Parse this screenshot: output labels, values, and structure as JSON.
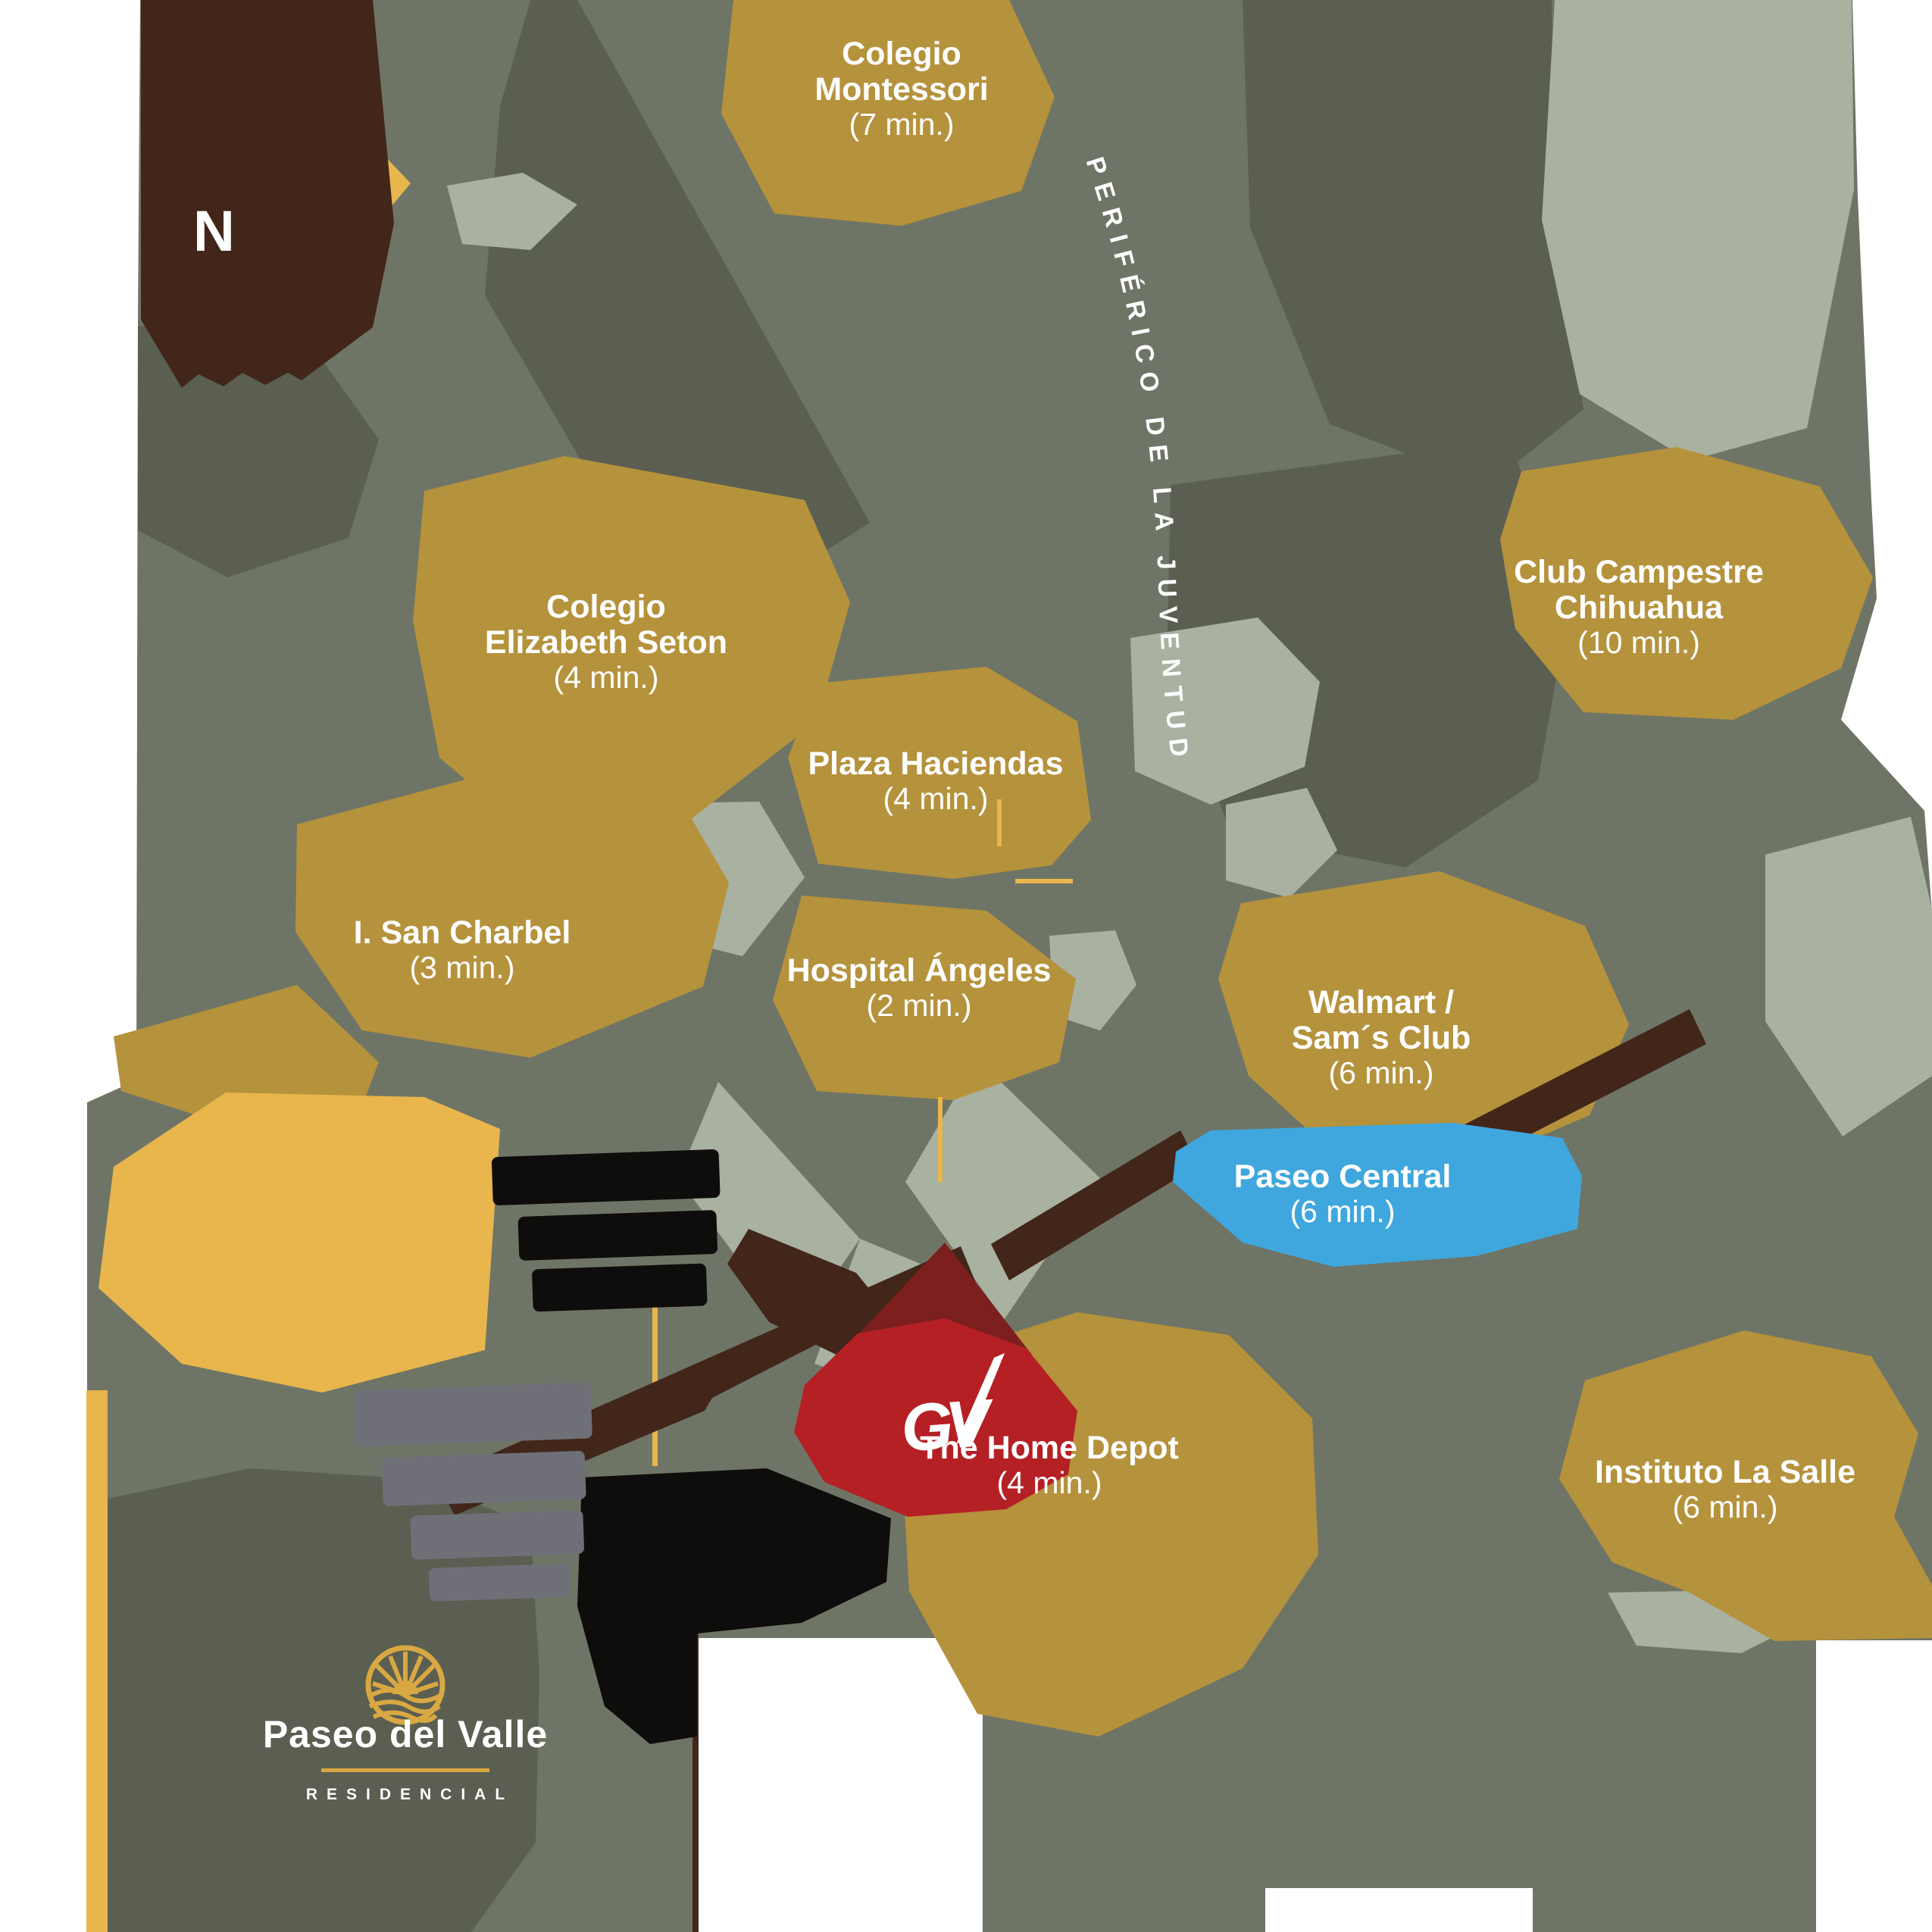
{
  "map": {
    "compass_label": "N",
    "road_label": "PERIFÉRICO DE LA JUVENTUD",
    "locations": [
      {
        "id": "colegio-montessori",
        "name": "Colegio\nMontessori",
        "time": "(7 min.)"
      },
      {
        "id": "club-campestre",
        "name": "Club Campestre\nChihuahua",
        "time": "(10 min.)"
      },
      {
        "id": "colegio-elizabeth-seton",
        "name": "Colegio\nElizabeth Seton",
        "time": "(4 min.)"
      },
      {
        "id": "plaza-haciendas",
        "name": "Plaza Haciendas",
        "time": "(4 min.)"
      },
      {
        "id": "i-san-charbel",
        "name": "I. San Charbel",
        "time": "(3 min.)"
      },
      {
        "id": "hospital-angeles",
        "name": "Hospital Ángeles",
        "time": "(2 min.)"
      },
      {
        "id": "walmart-sams-club",
        "name": "Walmart /\nSam´s Club",
        "time": "(6 min.)"
      },
      {
        "id": "paseo-central",
        "name": "Paseo Central",
        "time": "(6 min.)"
      },
      {
        "id": "the-home-depot",
        "name": "The Home Depot",
        "time": "(4 min.)"
      },
      {
        "id": "instituto-la-salle",
        "name": "Instituto La Salle",
        "time": "(6 min.)"
      }
    ],
    "brand": {
      "name": "Paseo del Valle",
      "tagline": "RESIDENCIAL",
      "developer_mark": "GV"
    },
    "palette": {
      "background": "#6f7566",
      "background_dark": "#5a5f51",
      "background_light": "#a9b1a1",
      "panel_dark": "#565b4c",
      "poi_gold": "#b5923c",
      "road_gold": "#e8b64d",
      "accent_brown": "#42261a",
      "accent_red": "#b52025",
      "accent_dark_red": "#7c1f1e",
      "accent_blue": "#3fa7dd",
      "accent_black": "#0f0d0b",
      "accent_gray": "#6f7077",
      "logo_gold": "#d9a843",
      "label_text": "#ffffff"
    }
  }
}
